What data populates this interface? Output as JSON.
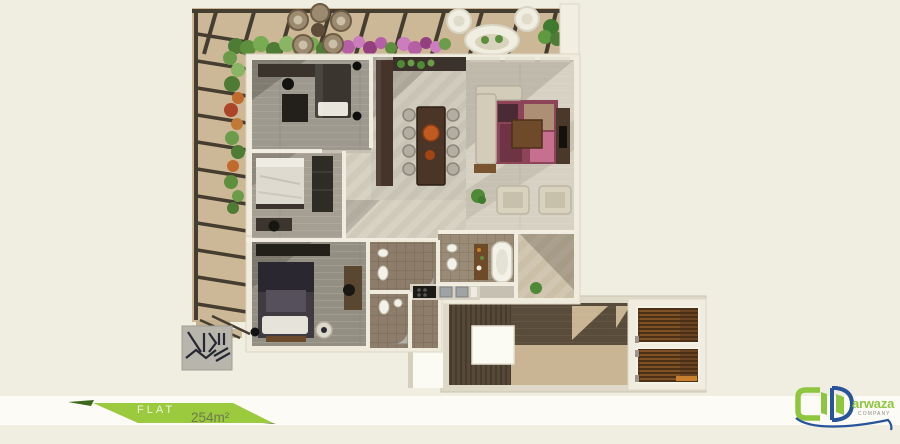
{
  "page": {
    "background": "#f0eee1",
    "band": "#fcfbf5"
  },
  "banner": {
    "label": "FLAT",
    "area": "254m²",
    "colors": {
      "green": "#9cca3e",
      "dark_green": "#3c671c",
      "label": "#ecf5d8",
      "area": "#6c7b4e"
    }
  },
  "logo": {
    "brand": "arwaza",
    "subtitle": "COMPANY",
    "colors": {
      "green": "#8ec63f",
      "blue": "#27549b",
      "subtitle": "#90908a"
    }
  },
  "plan": {
    "type": "apartment-floor-plan-render",
    "area_label": "254m²",
    "rooms": [
      "terrace",
      "office-bedroom",
      "bedroom",
      "master-bedroom",
      "kitchen",
      "dining",
      "living-room",
      "bathroom-1",
      "bathroom-2",
      "bathroom-3",
      "entrance-hall",
      "stairwell",
      "elevators"
    ],
    "colors": {
      "terrace": "#ccb897",
      "pergola": "#463d31",
      "walls": "#efebdd",
      "floor": "#c5c0b2",
      "floor_dark": "#9d998e",
      "tile": "#8d7d6a",
      "rug": "#8e4458",
      "stairs": "#564938",
      "landing": "#c9b593",
      "elevator_wood": "#6b4423",
      "accent_orange": "#bf5a22"
    }
  }
}
